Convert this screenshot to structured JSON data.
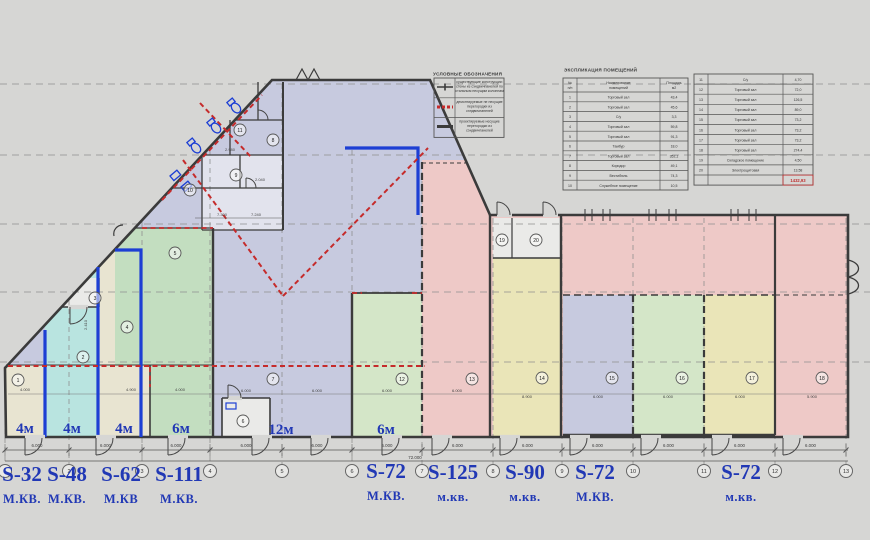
{
  "legend": {
    "title": "УСЛОВНЫЕ ОБОЗНАЧЕНИЯ",
    "rows": [
      {
        "symbol": "existing-wall-symbol",
        "lines": [
          "существующие конструкции:",
          "стены из сэндвичпанелей по",
          "стальным несущим колоннам"
        ]
      },
      {
        "symbol": "demolished-partition-symbol",
        "lines": [
          "демонтируемые не несущие",
          "перегородки из",
          "сэндвичпанелей"
        ]
      },
      {
        "symbol": "new-partition-symbol",
        "lines": [
          "проектируемые несущие",
          "перегородки из",
          "сэндвичпанелей"
        ]
      }
    ]
  },
  "explication": {
    "title": "ЭКСПЛИКАЦИЯ ПОМЕЩЕНИЙ",
    "headers": {
      "num": "№ п/п",
      "name": "Наименование помещений",
      "area": "Площадь м2"
    },
    "rooms": [
      {
        "num": "1",
        "name": "Торговый зал",
        "area": "43,4"
      },
      {
        "num": "2",
        "name": "Торговый зал",
        "area": "45,6"
      },
      {
        "num": "3",
        "name": "С/у",
        "area": "3,3"
      },
      {
        "num": "4",
        "name": "Торговый зал",
        "area": "59,8"
      },
      {
        "num": "5",
        "name": "Торговый зал",
        "area": "91,3"
      },
      {
        "num": "6",
        "name": "Тамбур",
        "area": "18,0"
      },
      {
        "num": "7",
        "name": "Торговый зал",
        "area": "352,1"
      },
      {
        "num": "8",
        "name": "Коридор",
        "area": "49,1"
      },
      {
        "num": "9",
        "name": "Вестибюль",
        "area": "74,3"
      },
      {
        "num": "10",
        "name": "Служебное помещение",
        "area": "10,5"
      },
      {
        "num": "11",
        "name": "С/у",
        "area": "4,70"
      },
      {
        "num": "12",
        "name": "Торговый зал",
        "area": "72,0"
      },
      {
        "num": "13",
        "name": "Торговый зал",
        "area": "126,5"
      },
      {
        "num": "14",
        "name": "Торговый зал",
        "area": "89,0"
      },
      {
        "num": "15",
        "name": "Торговый зал",
        "area": "73,2"
      },
      {
        "num": "16",
        "name": "Торговый зал",
        "area": "73,2"
      },
      {
        "num": "17",
        "name": "Торговый зал",
        "area": "73,2"
      },
      {
        "num": "18",
        "name": "Торговый зал",
        "area": "274,4"
      },
      {
        "num": "19",
        "name": "Складское помещение",
        "area": "4,50"
      },
      {
        "num": "20",
        "name": "Электрощитовая",
        "area": "13,58"
      }
    ],
    "total": "1432,93"
  },
  "plan": {
    "height_labels": [
      "4м",
      "4м",
      "4м",
      "6м",
      "12м",
      "6м"
    ],
    "unit_labels": [
      {
        "s": "S-32",
        "u": "М.КВ."
      },
      {
        "s": "S-48",
        "u": "М.КВ."
      },
      {
        "s": "S-62",
        "u": "М.КВ"
      },
      {
        "s": "S-111",
        "u": "М.КВ."
      },
      {
        "s": "S-72",
        "u": "М.КВ."
      },
      {
        "s": "S-125",
        "u": "м.кв."
      },
      {
        "s": "S-90",
        "u": "м.кв."
      },
      {
        "s": "S-72",
        "u": "М.КВ."
      },
      {
        "s": "S-72",
        "u": "м.кв."
      }
    ],
    "grid_bubbles": [
      "1",
      "2",
      "3",
      "4",
      "5",
      "6",
      "7",
      "8",
      "9",
      "10",
      "11",
      "12",
      "13"
    ],
    "room_numbers": [
      "1",
      "2",
      "3",
      "4",
      "5",
      "6",
      "7",
      "8",
      "9",
      "10",
      "11",
      "12",
      "13",
      "14",
      "15",
      "16",
      "17",
      "18",
      "19",
      "20"
    ],
    "bay_dim": "6.000",
    "overall_dim": "72.000",
    "interior_dims": [
      "4.000",
      "4.900",
      "4.000",
      "6.000",
      "6.000",
      "6.000",
      "6.000",
      "8.900",
      "6.000",
      "6.000",
      "6.000",
      "5.900",
      "2.980",
      "2.040",
      "7.300",
      "7.240"
    ],
    "vertical_dim": "2.410"
  },
  "colors": {
    "background": "#d6d6d4",
    "wall": "#3b3b3b",
    "new_partition_blue": "#1d3fd4",
    "demolition_red": "#c52b2b",
    "label_blue": "#2138b5",
    "zone_lavender": "#c7cadf",
    "zone_green": "#c3dec0",
    "zone_light_green": "#d4e6c8",
    "zone_cyan": "#b9e4e0",
    "zone_beige": "#e8e4d1",
    "zone_yellow": "#eae5b8",
    "zone_pink": "#eec9c7",
    "room_white": "#eaeae8",
    "total_red": "#c03030",
    "grid_gray": "#8f8f8f"
  }
}
